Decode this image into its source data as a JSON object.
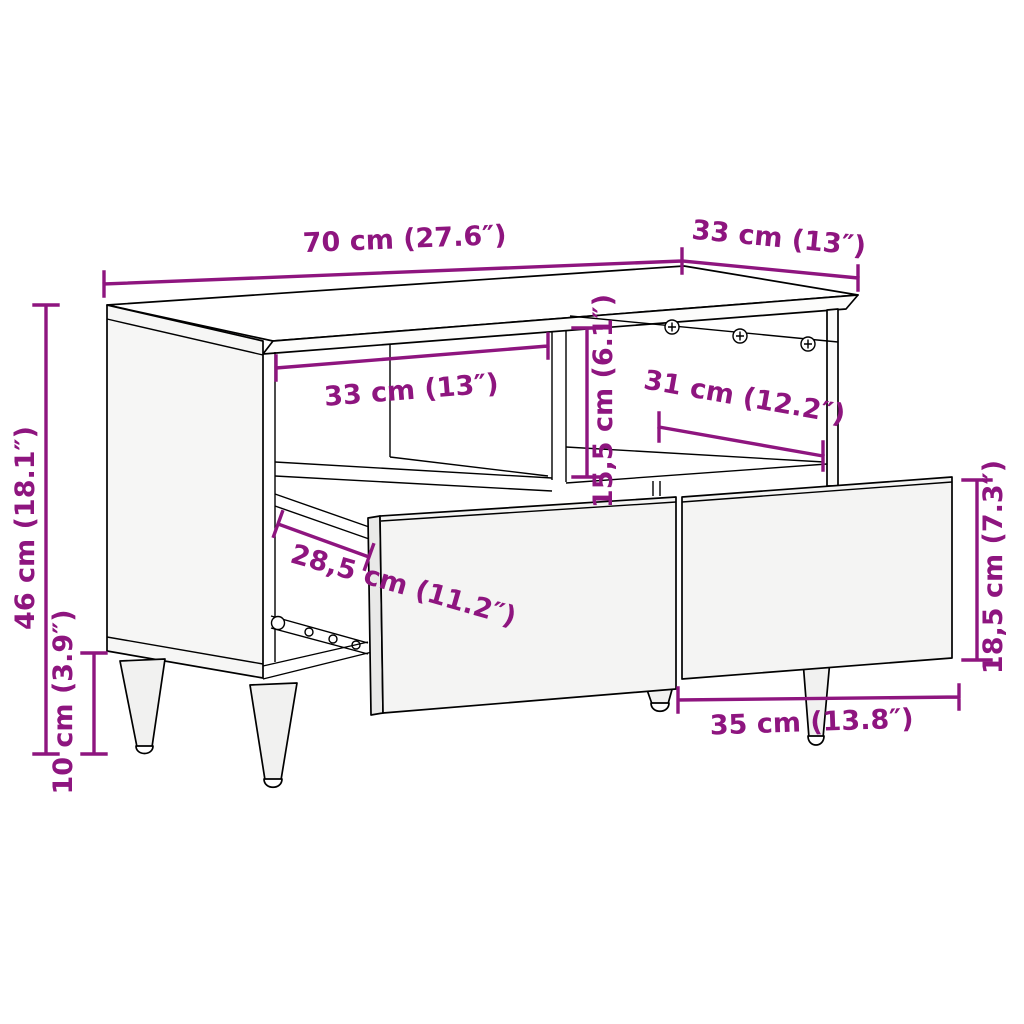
{
  "diagram": {
    "accent_color": "#8E157F",
    "line_color": "#000000",
    "background_color": "#FFFFFF",
    "dimension_labels": {
      "top_width": "70 cm (27.6″)",
      "top_depth": "33 cm (13″)",
      "total_height": "46 cm (18.1″)",
      "leg_height": "10 cm (3.9″)",
      "compartment_width": "33 cm (13″)",
      "compartment_height": "15,5 cm (6.1″)",
      "compartment_depth": "31 cm (12.2″)",
      "drawer_slide_depth": "28,5 cm (11.2″)",
      "drawer_front_height": "18,5 cm (7.3″)",
      "drawer_front_width": "35 cm (13.8″)"
    }
  }
}
